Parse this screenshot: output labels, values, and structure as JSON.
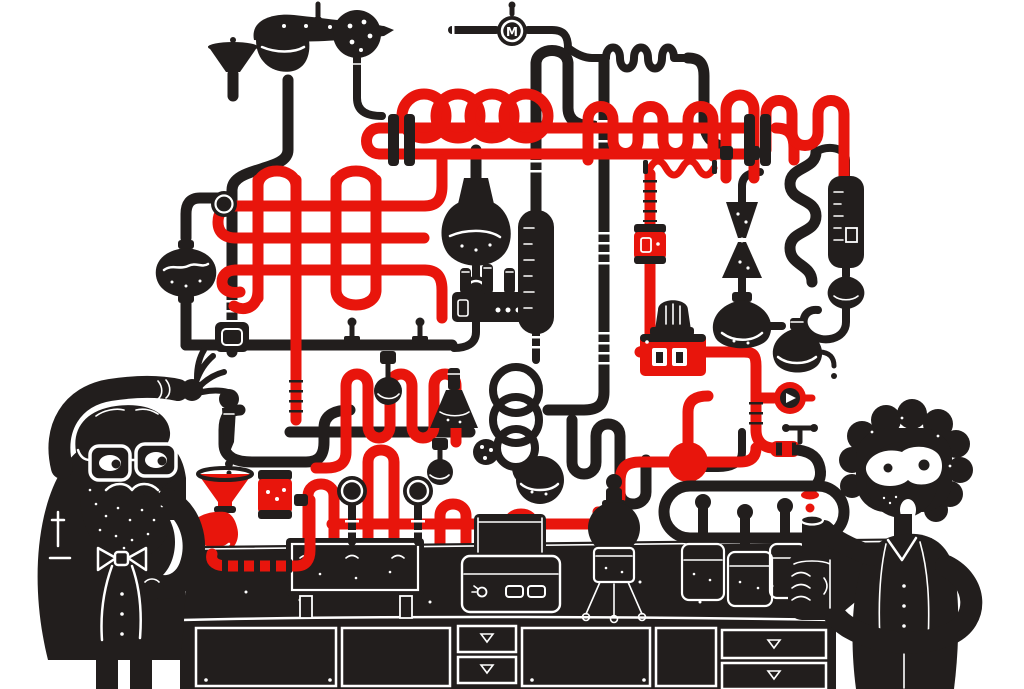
{
  "scene": {
    "type": "illustration",
    "alt": "Two cartoon scientists tend a sprawling contraption of black and red laboratory pipes, flasks, coils and gauges mounted above a black laboratory bench",
    "colors": {
      "paper": "#ffffff",
      "ink": "#221e1d",
      "accent": "#e8150c"
    },
    "gauge_label": "M",
    "characters": {
      "left_scientist": "bearded professor with glasses and bow tie pressing a dropper",
      "right_scientist": "curly-haired assistant catching a red drip in a bottle"
    },
    "equipment": [
      "funnel",
      "pipe-bowl-vessel",
      "perforated-ball",
      "loop-coil",
      "pipe-weave",
      "round-flask",
      "clock-gauge",
      "manifold-with-test-tubes",
      "condenser",
      "spiral-coil",
      "erlenmeyer-flask",
      "serpentine",
      "control-box",
      "beacon-lamp",
      "pressure-gauge",
      "ball-junction",
      "hourglass-vessel",
      "canister",
      "graduated-cylinder",
      "water-bath",
      "hot-plate",
      "tripod-flask",
      "bottles",
      "faucet",
      "dropper",
      "red-funnel",
      "horn",
      "striped-hose",
      "lab-bench"
    ]
  }
}
